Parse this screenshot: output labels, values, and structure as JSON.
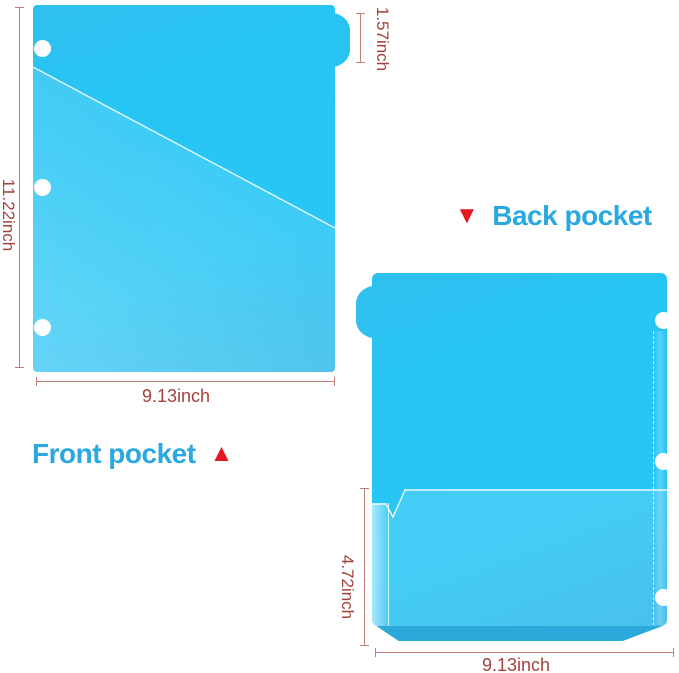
{
  "front": {
    "label": "Front pocket",
    "marker_up": "▲",
    "dim_height": "11.22inch",
    "dim_width": "9.13inch",
    "dim_tab": "1.57inch"
  },
  "back": {
    "label": "Back pocket",
    "marker_down": "▼",
    "dim_pocket_height": "4.72inch",
    "dim_width": "9.13inch"
  },
  "colors": {
    "folder_cyan": "#29c6f5",
    "folder_edge": "#2db8e9",
    "pocket_bottom_weld": "#2ba9da",
    "dim_text": "#a2423d",
    "dim_line": "#c08078",
    "label_blue": "#2aa8e1",
    "marker_red": "#e8161f",
    "hole_white": "#ffffff",
    "background": "#ffffff"
  }
}
